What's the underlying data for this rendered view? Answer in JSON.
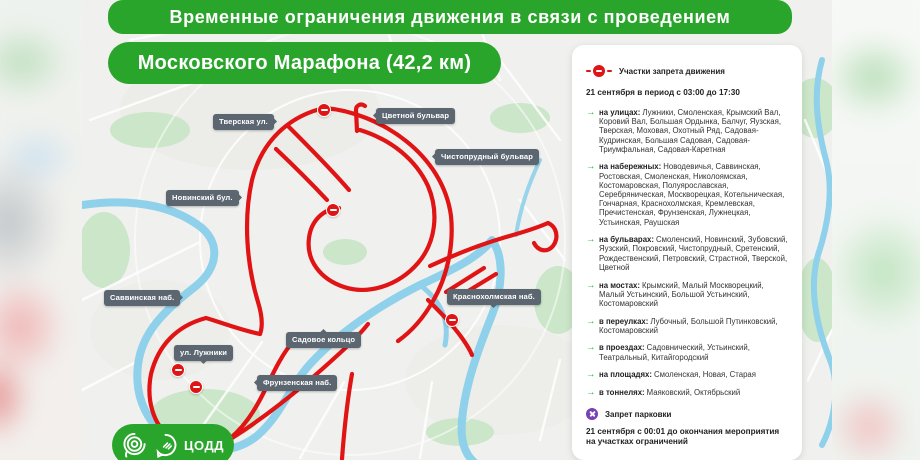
{
  "title": {
    "line1": "Временные ограничения движения в связи с проведением",
    "line2": "Московского Марафона (42,2 км)"
  },
  "map": {
    "labels": [
      {
        "text": "Тверская ул."
      },
      {
        "text": "Цветной бульвар"
      },
      {
        "text": "Чистопрудный бульвар"
      },
      {
        "text": "Новинский бул."
      },
      {
        "text": "Саввинская наб."
      },
      {
        "text": "Краснохолмская наб."
      },
      {
        "text": "Садовое кольцо"
      },
      {
        "text": "ул. Лужники"
      },
      {
        "text": "Фрунзенская наб."
      }
    ]
  },
  "panel": {
    "legend_label": "Участки запрета движения",
    "schedule": "21 сентября в период с 03:00 до 17:30",
    "sections": [
      {
        "prefix": "на улицах:",
        "items": "Лужники, Смоленская, Крымский Вал, Коровий Вал, Большая Ордынка, Балчуг, Яузская, Тверская, Моховая, Охотный Ряд, Садовая-Кудринская, Большая Садовая, Садовая-Триумфальная, Садовая-Каретная"
      },
      {
        "prefix": "на набережных:",
        "items": "Новодевичья, Саввинская, Ростовская, Смоленская, Николоямская, Костомаровская, Полуярославская, Серебряническая, Москворецкая, Котельническая, Гончарная, Краснохолмская, Кремлевская, Пречистенская, Фрунзенская, Лужнецкая, Устьинская, Раушская"
      },
      {
        "prefix": "на бульварах:",
        "items": "Смоленский, Новинский, Зубовский, Яузский, Покровский, Чистопрудный, Сретенский, Рождественский, Петровский, Страстной, Тверской, Цветной"
      },
      {
        "prefix": "на мостах:",
        "items": "Крымский, Малый Москворецкий, Малый Устьинский, Большой Устьинский, Костомаровский"
      },
      {
        "prefix": "в переулках:",
        "items": "Лубочный, Большой Путинковский, Костомаровский"
      },
      {
        "prefix": "в проездах:",
        "items": "Садовнический, Устьинский, Театральный, Китайгородский"
      },
      {
        "prefix": "на площадях:",
        "items": "Смоленская, Новая, Старая"
      },
      {
        "prefix": "в тоннелях:",
        "items": "Маяковский, Октябрьский"
      }
    ],
    "parking_label": "Запрет парковки",
    "parking_note": "21 сентября с 00:01 до окончания мероприятия на участках ограничений"
  },
  "logo": {
    "text": "ЦОДД"
  },
  "icons": {
    "arrow_glyph": "→",
    "route_ban_icon": "no-entry-circle",
    "parking_ban_icon": "crossed-circle"
  },
  "colors": {
    "green": "#2aa52c",
    "route_red": "#e01414",
    "tag_slate": "#5b6670",
    "parking_purple": "#7a3fb0",
    "river_blue": "#8fd0ea"
  }
}
